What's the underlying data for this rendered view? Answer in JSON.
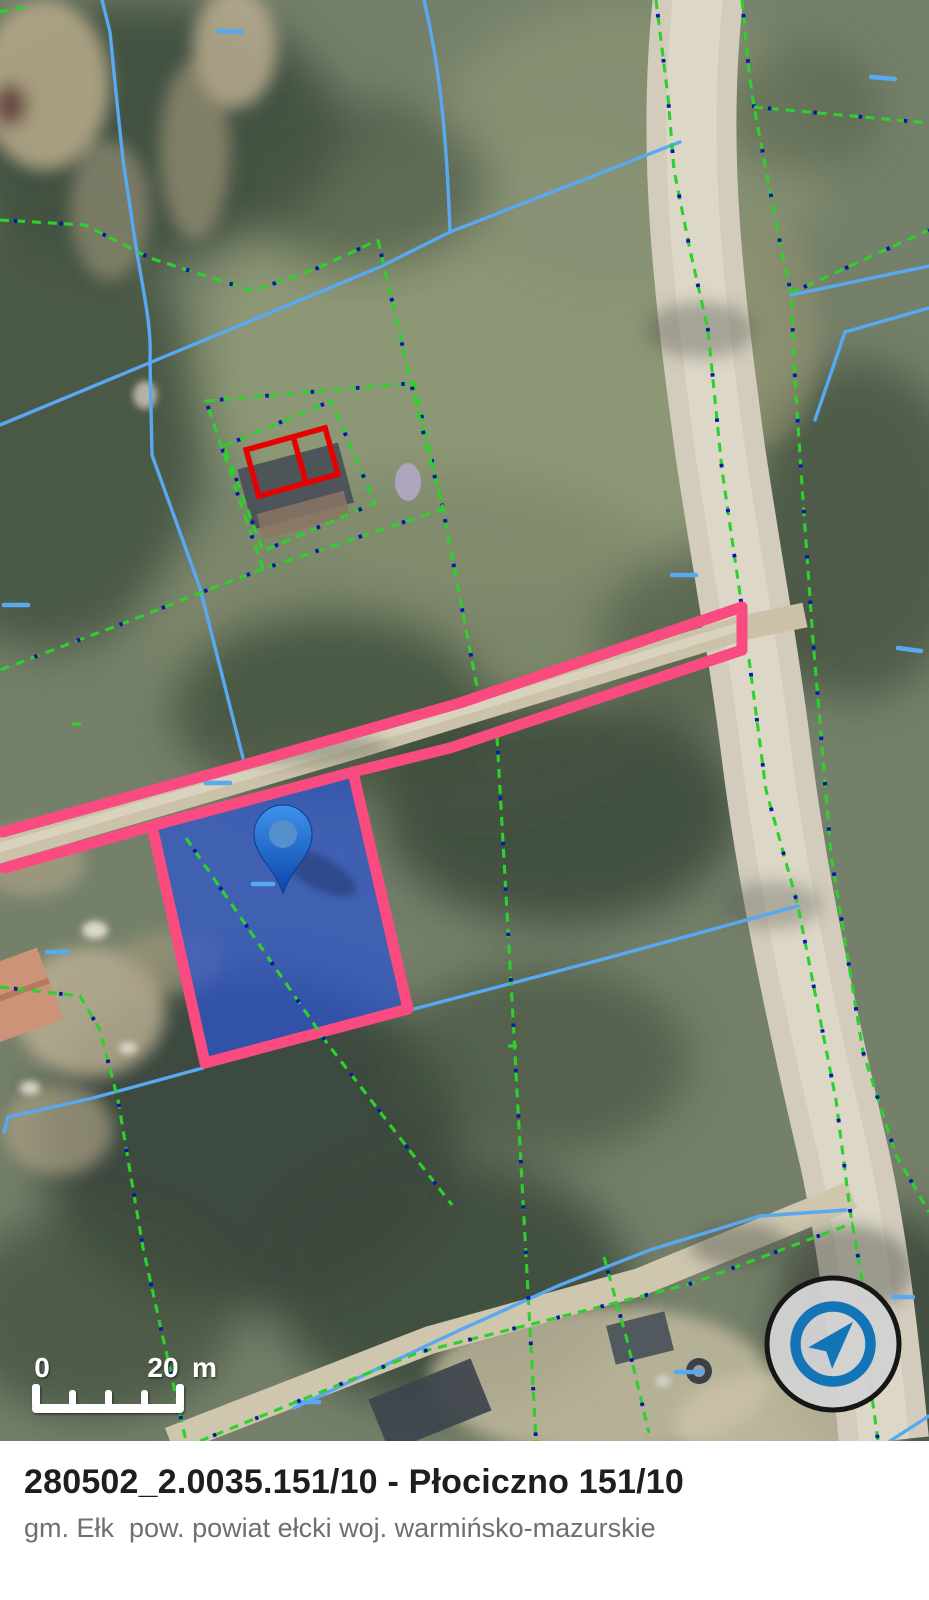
{
  "info_bar": {
    "title": "280502_2.0035.151/10 - Płociczno 151/10",
    "subtitle": "gm. Ełk  pow. powiat ełcki woj. warmińsko-mazurskie"
  },
  "scale_bar": {
    "zero_label": "0",
    "distance_label": "20",
    "unit_label": "m"
  },
  "icons": {
    "compass": "compass-navigation-icon",
    "marker": "location-pin-icon"
  },
  "colors": {
    "pink": "#fa4b80",
    "parcel-fill": "#2e55cc",
    "line-blue": "#58a8f2",
    "line-green": "#2ed02e",
    "line-navy": "#0a18a8",
    "building-red": "#e60000",
    "compass-blue": "#1375b7",
    "compass-bg": "#d2d2d2",
    "pin-top": "#3f93ea",
    "pin-bottom": "#0b46ab",
    "title-color": "#1e1e1e",
    "subtitle-color": "#6f6f6f"
  }
}
